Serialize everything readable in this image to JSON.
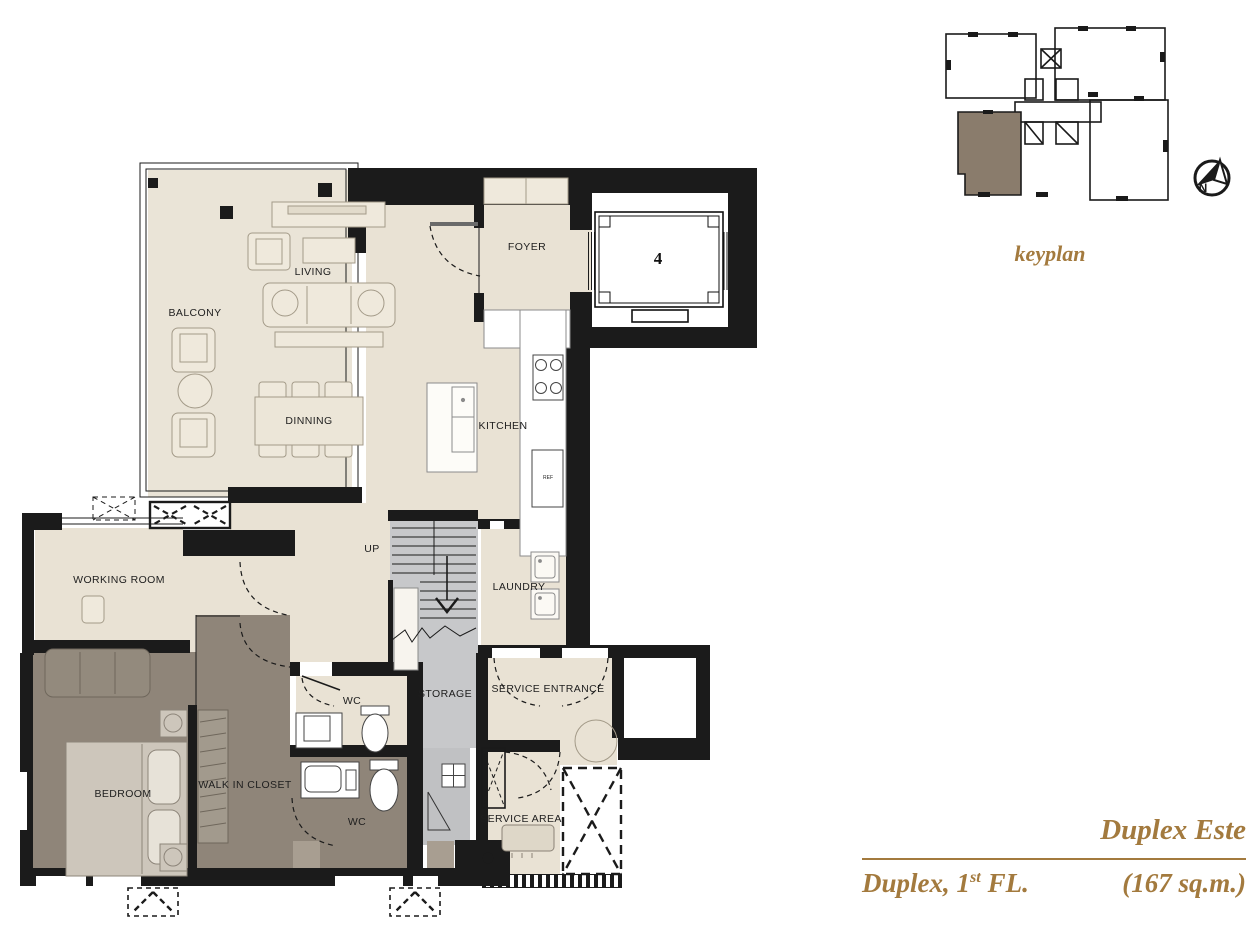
{
  "plan": {
    "rooms": [
      {
        "id": "balcony",
        "label": "BALCONY"
      },
      {
        "id": "living",
        "label": "LIVING"
      },
      {
        "id": "dinning",
        "label": "DINNING"
      },
      {
        "id": "foyer",
        "label": "FOYER"
      },
      {
        "id": "kitchen",
        "label": "KITCHEN"
      },
      {
        "id": "working-room",
        "label": "WORKING ROOM"
      },
      {
        "id": "stairs-up",
        "label": "UP"
      },
      {
        "id": "laundry",
        "label": "LAUNDRY"
      },
      {
        "id": "storage",
        "label": "STORAGE"
      },
      {
        "id": "service-entrance",
        "label": "SERVICE ENTRANCE"
      },
      {
        "id": "wc-upper",
        "label": "WC"
      },
      {
        "id": "wc-lower",
        "label": "WC"
      },
      {
        "id": "bedroom",
        "label": "BEDROOM"
      },
      {
        "id": "walk-in-closet",
        "label": "WALK IN CLOSET"
      },
      {
        "id": "service-area",
        "label": "SERVICE AREA"
      }
    ],
    "elevator_number": "4",
    "ref_label": "REF"
  },
  "keyplan": {
    "caption": "keyplan"
  },
  "north": {
    "letter": "N"
  },
  "title_block": {
    "unit_name": "Duplex Este",
    "floor_prefix": "Duplex, 1",
    "floor_sup": "st",
    "floor_suffix": " FL.",
    "area": "(167 sq.m.)"
  },
  "colors": {
    "accent_gold": "#a37a3e",
    "wall_black": "#1b1b1b",
    "floor_cream": "#e9e2d4",
    "floor_taupe": "#8f8579",
    "floor_gray": "#c7c8ca",
    "keyplan_highlight": "#8a7c6c"
  }
}
